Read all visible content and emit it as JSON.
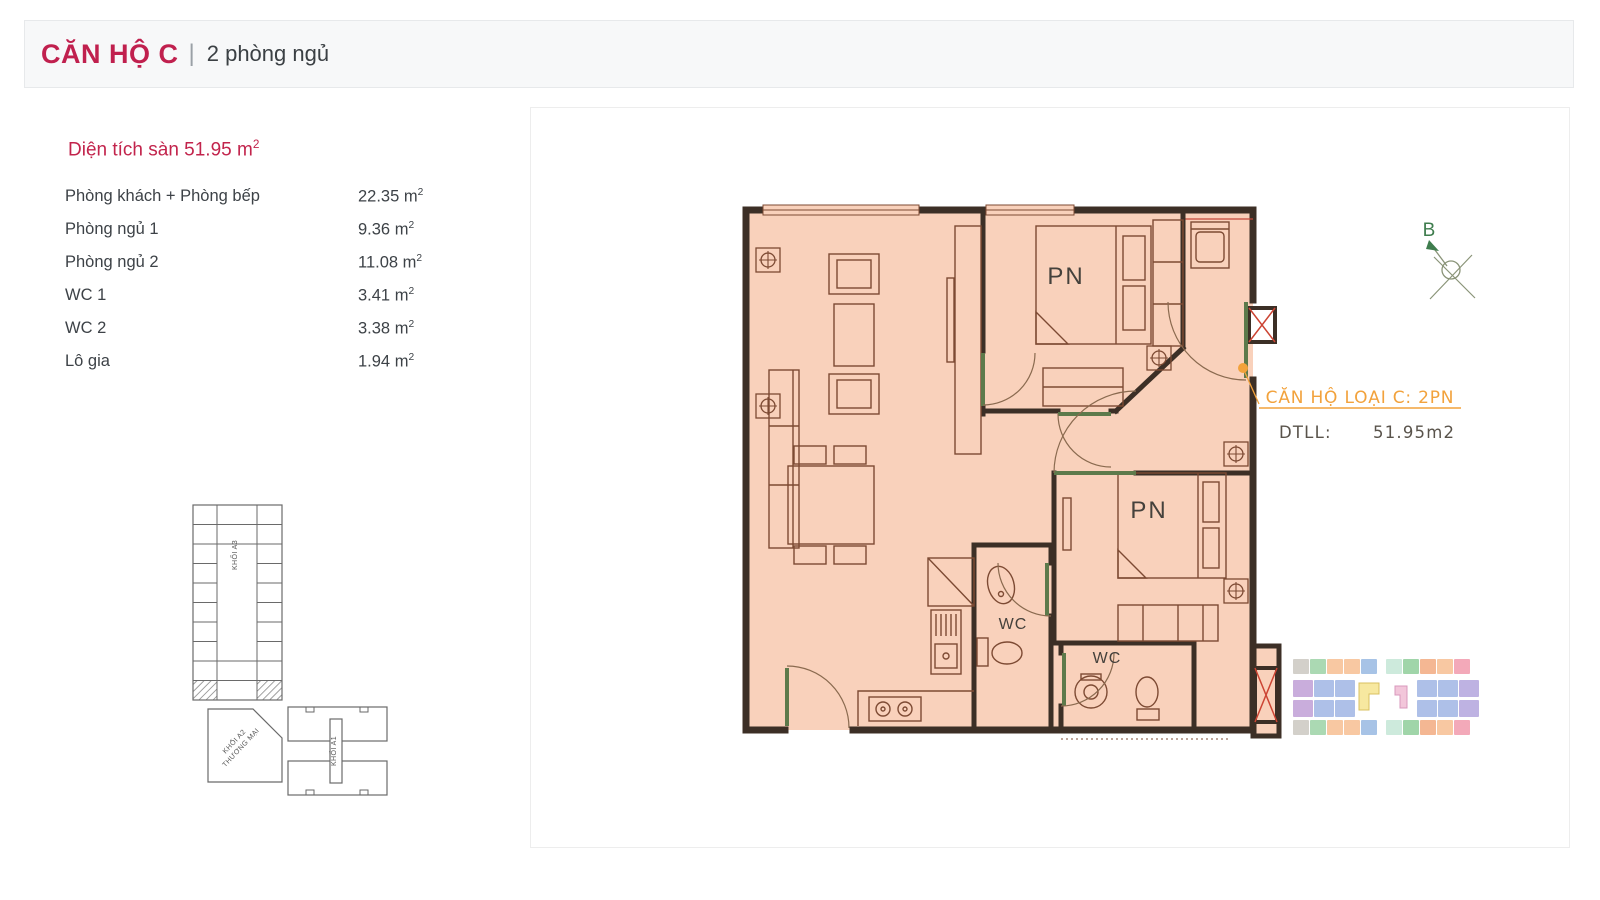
{
  "header": {
    "title": "CĂN HỘ C",
    "divider": "|",
    "subtitle": "2 phòng ngủ"
  },
  "areas": {
    "title_prefix": "Diện tích sàn 51.95 m",
    "sup": "2",
    "rows": [
      {
        "label": "Phòng khách + Phòng bếp",
        "value": "22.35 m"
      },
      {
        "label": "Phòng ngủ 1",
        "value": "9.36 m"
      },
      {
        "label": "Phòng ngủ 2",
        "value": "11.08 m"
      },
      {
        "label": "WC 1",
        "value": "3.41 m"
      },
      {
        "label": "WC 2",
        "value": "3.38 m"
      },
      {
        "label": "Lô gia",
        "value": "1.94 m"
      }
    ]
  },
  "floorplan": {
    "bedroom1_label": "PN",
    "bedroom2_label": "PN",
    "wc1_label": "WC",
    "wc2_label": "WC",
    "compass_label": "B",
    "annotation": {
      "title": "CĂN HỘ LOẠI C: 2PN",
      "area_label": "DTLL:",
      "area_value": "51.95m2",
      "accent_color": "#f2a23c"
    },
    "fill_color": "#f9d1bb",
    "wall_color": "#3c2f26",
    "line_color": "#7d4a33",
    "door_color": "#5d7a4b",
    "shaft_x_color": "#cc4433",
    "compass_color": "#3f7d4e"
  },
  "site_diagram": {
    "block_a3_label": "KHỐI A3",
    "block_a2_label_line1": "KHỐI A2",
    "block_a2_label_line2": "THƯƠNG MẠI",
    "block_a1_label": "KHỐI A1"
  },
  "minimap": {
    "rows": [
      {
        "y": 0,
        "h": 15,
        "left_x": 0,
        "cell_w": 17,
        "left": [
          "#d3d0ca",
          "#abd9b3",
          "#f8c8a2",
          "#f8c8a2",
          "#a7c3e6"
        ],
        "right_x": 93,
        "right": [
          "#cdeadc",
          "#a0d5a9",
          "#f4b793",
          "#f8c8a2",
          "#f3a9b9"
        ]
      },
      {
        "y": 21,
        "h": 17,
        "left_x": 0,
        "cell_w": 21,
        "left": [
          "#c9addc",
          "#aec0e8",
          "#aec0e8"
        ],
        "right_x": 124,
        "right": [
          "#aec0e8",
          "#aec0e8",
          "#beb2e2"
        ]
      },
      {
        "y": 41,
        "h": 17,
        "left_x": 0,
        "cell_w": 21,
        "left": [
          "#c9addc",
          "#aec0e8",
          "#aec0e8"
        ],
        "right_x": 124,
        "right": [
          "#aec0e8",
          "#aec0e8",
          "#beb2e2"
        ]
      },
      {
        "y": 61,
        "h": 15,
        "left_x": 0,
        "cell_w": 17,
        "left": [
          "#d3d0ca",
          "#abd9b3",
          "#f8c8a2",
          "#f8c8a2",
          "#a7c3e6"
        ],
        "right_x": 93,
        "right": [
          "#cdeadc",
          "#a0d5a9",
          "#f4b793",
          "#f8c8a2",
          "#f3a9b9"
        ]
      }
    ],
    "center_yellow": "#f7e8a0",
    "center_yellow_border": "#d8c060",
    "center_pink": "#f2c6da",
    "center_pink_border": "#d898bc"
  }
}
